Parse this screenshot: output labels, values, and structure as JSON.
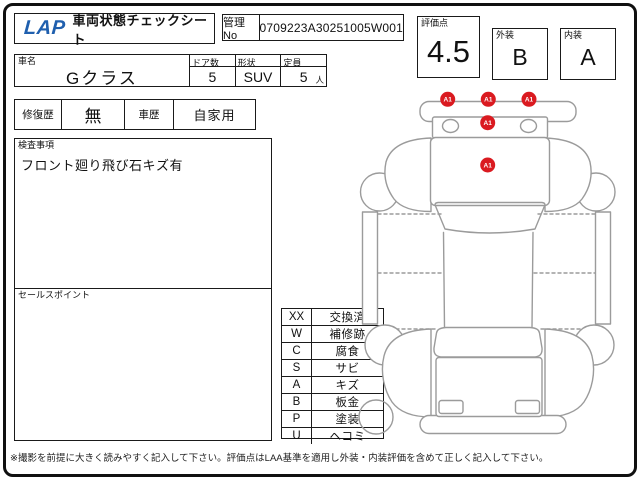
{
  "header": {
    "logo": "LAP",
    "title": "車両状態チェックシート",
    "mgmt_label": "管理No",
    "mgmt_value": "0709223A30251005W001"
  },
  "scores": {
    "overall_label": "評価点",
    "overall_value": "4.5",
    "exterior_label": "外装",
    "exterior_value": "B",
    "interior_label": "内装",
    "interior_value": "A"
  },
  "vehicle": {
    "name_label": "車名",
    "name_value": "Gクラス",
    "doors_label": "ドア数",
    "doors_value": "5",
    "shape_label": "形状",
    "shape_value": "SUV",
    "capacity_label": "定員",
    "capacity_value": "5",
    "capacity_unit": "人",
    "repair_label": "修復歴",
    "repair_value": "無",
    "history_label": "車歴",
    "history_value": "自家用"
  },
  "inspection": {
    "label": "検査事項",
    "note": "フロント廻り飛び石キズ有"
  },
  "sales_point": {
    "label": "セールスポイント",
    "note": ""
  },
  "legend": {
    "rows": [
      {
        "code": "XX",
        "label": "交換済"
      },
      {
        "code": "W",
        "label": "補修跡"
      },
      {
        "code": "C",
        "label": "腐食"
      },
      {
        "code": "S",
        "label": "サビ"
      },
      {
        "code": "A",
        "label": "キズ"
      },
      {
        "code": "B",
        "label": "板金"
      },
      {
        "code": "P",
        "label": "塗装"
      },
      {
        "code": "U",
        "label": "ヘコミ"
      }
    ]
  },
  "diagram": {
    "marker_color": "#da1a20",
    "markers": [
      {
        "label": "A1",
        "location": "front-bumper-left"
      },
      {
        "label": "A1",
        "location": "front-bumper-center"
      },
      {
        "label": "A1",
        "location": "front-bumper-right"
      },
      {
        "label": "A1",
        "location": "front-panel-center"
      },
      {
        "label": "A1",
        "location": "hood-center"
      }
    ]
  },
  "footer": {
    "note": "※撮影を前提に大きく読みやすく記入して下さい。評価点はLAA基準を適用し外装・内装評価を含めて正しく記入して下さい。"
  },
  "colors": {
    "logo_blue": "#1f5fae",
    "marker_red": "#da1a20",
    "line_gray": "#9b9b9b"
  }
}
